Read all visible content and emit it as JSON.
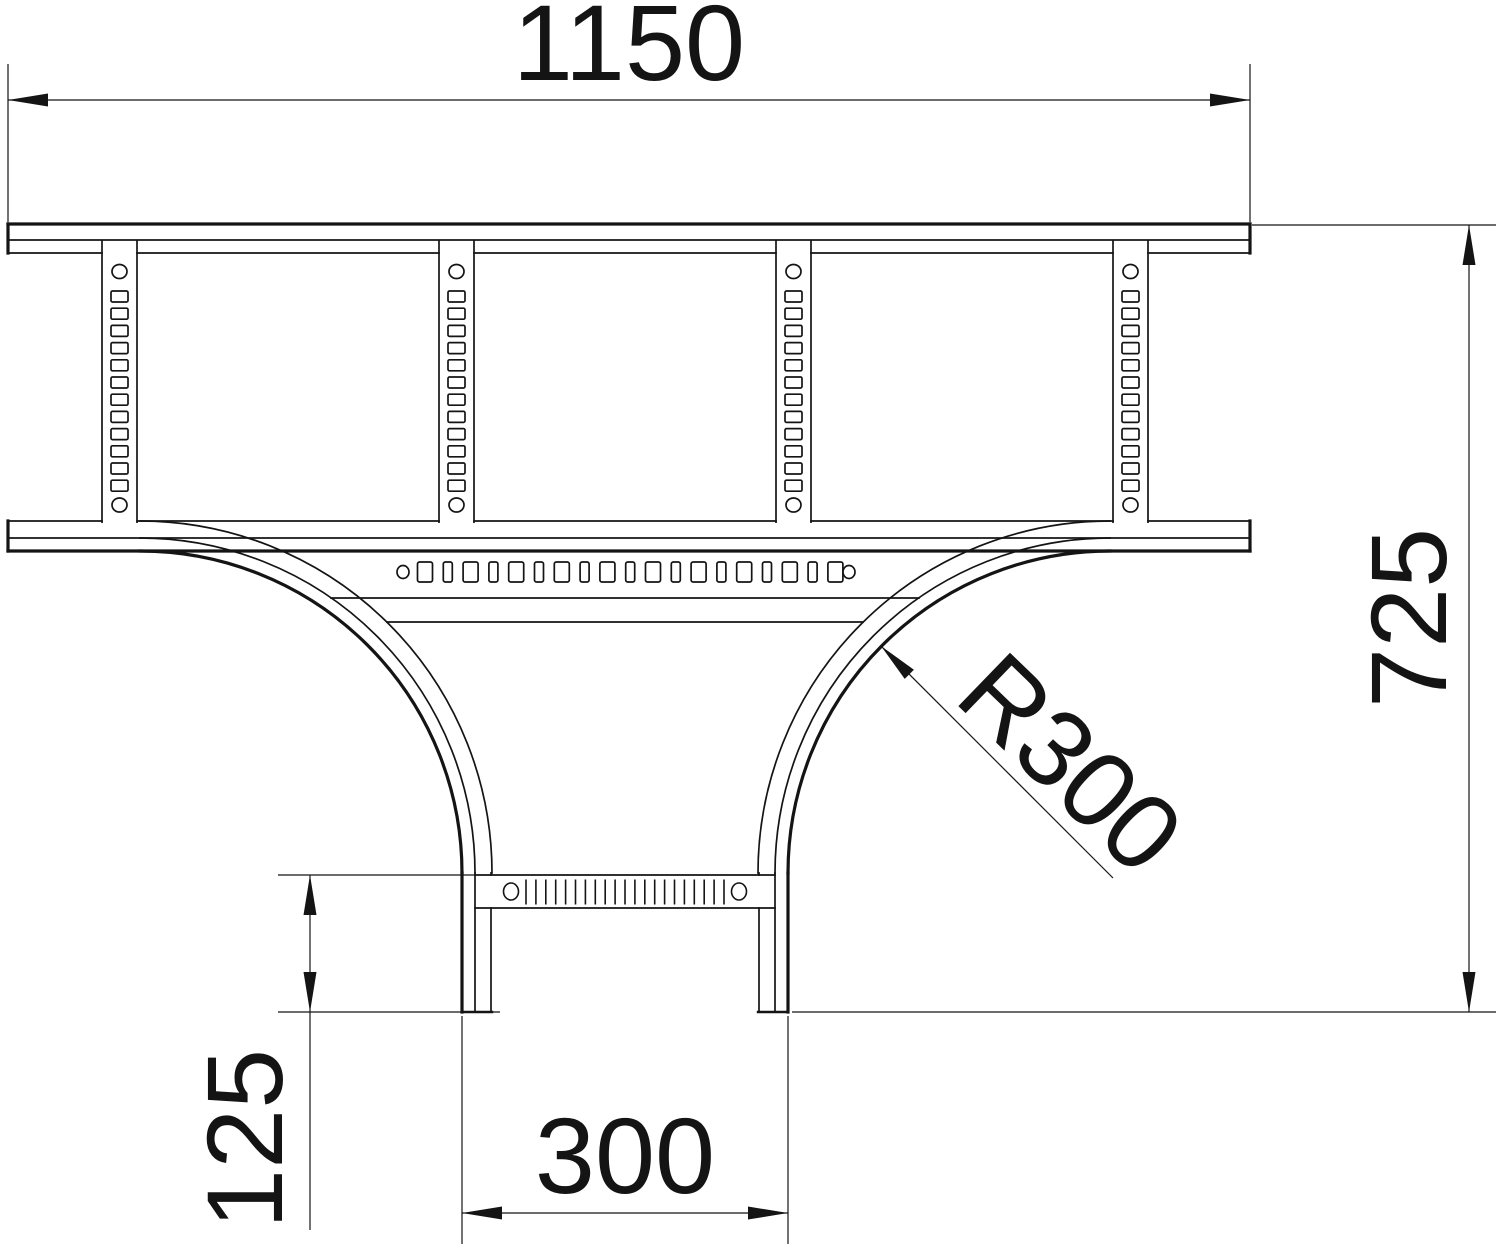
{
  "drawing": {
    "title": "Cable ladder T-piece plan view",
    "background": "#ffffff",
    "line_color": "#141414",
    "dimensions": [
      {
        "id": "overall-width",
        "label": "1150",
        "orientation": "horizontal"
      },
      {
        "id": "overall-height",
        "label": "725",
        "orientation": "vertical"
      },
      {
        "id": "bend-radius",
        "label": "R300",
        "orientation": "diagonal"
      },
      {
        "id": "branch-width",
        "label": "300",
        "orientation": "horizontal"
      },
      {
        "id": "rung-offset",
        "label": "125",
        "orientation": "vertical"
      }
    ],
    "structure": {
      "top_rungs": 4,
      "rung_slots_per_rung": 12,
      "plate_holes": 19,
      "branch_slots": 21
    }
  }
}
